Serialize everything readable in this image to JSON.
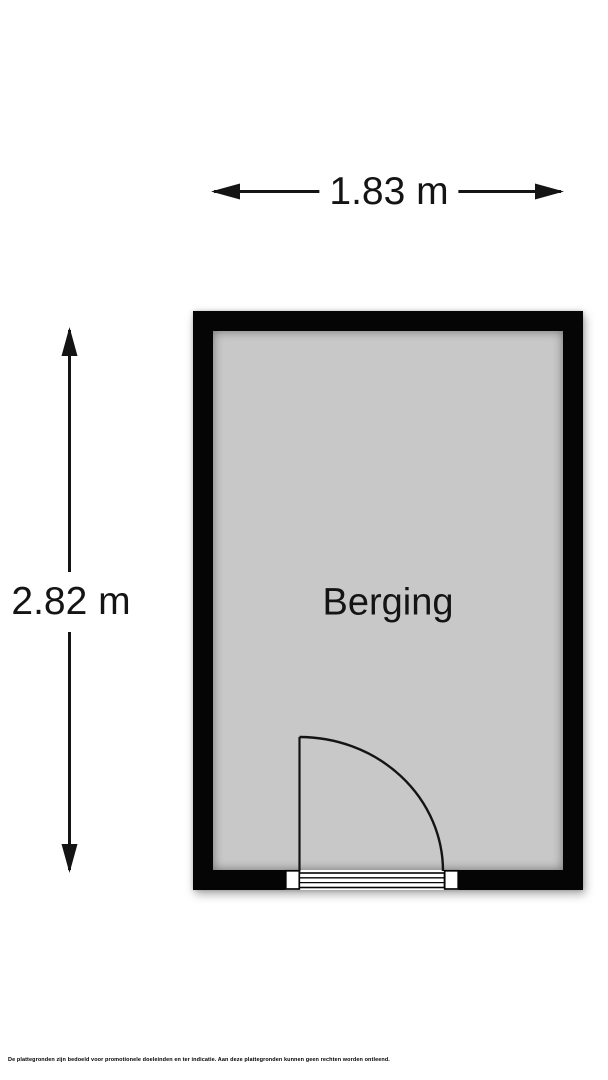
{
  "dimensions": {
    "width": {
      "label": "1.83 m"
    },
    "height": {
      "label": "2.82 m"
    }
  },
  "room": {
    "name": "Berging"
  },
  "footer": {
    "disclaimer": "De plattegronden zijn bedoeld voor promotionele doeleinden en ter indicatie. Aan deze plattegronden kunnen geen rechten worden ontleend."
  },
  "colors": {
    "wall": "#050505",
    "floor": "#c8c8c8",
    "line": "#141414",
    "background": "#ffffff"
  }
}
